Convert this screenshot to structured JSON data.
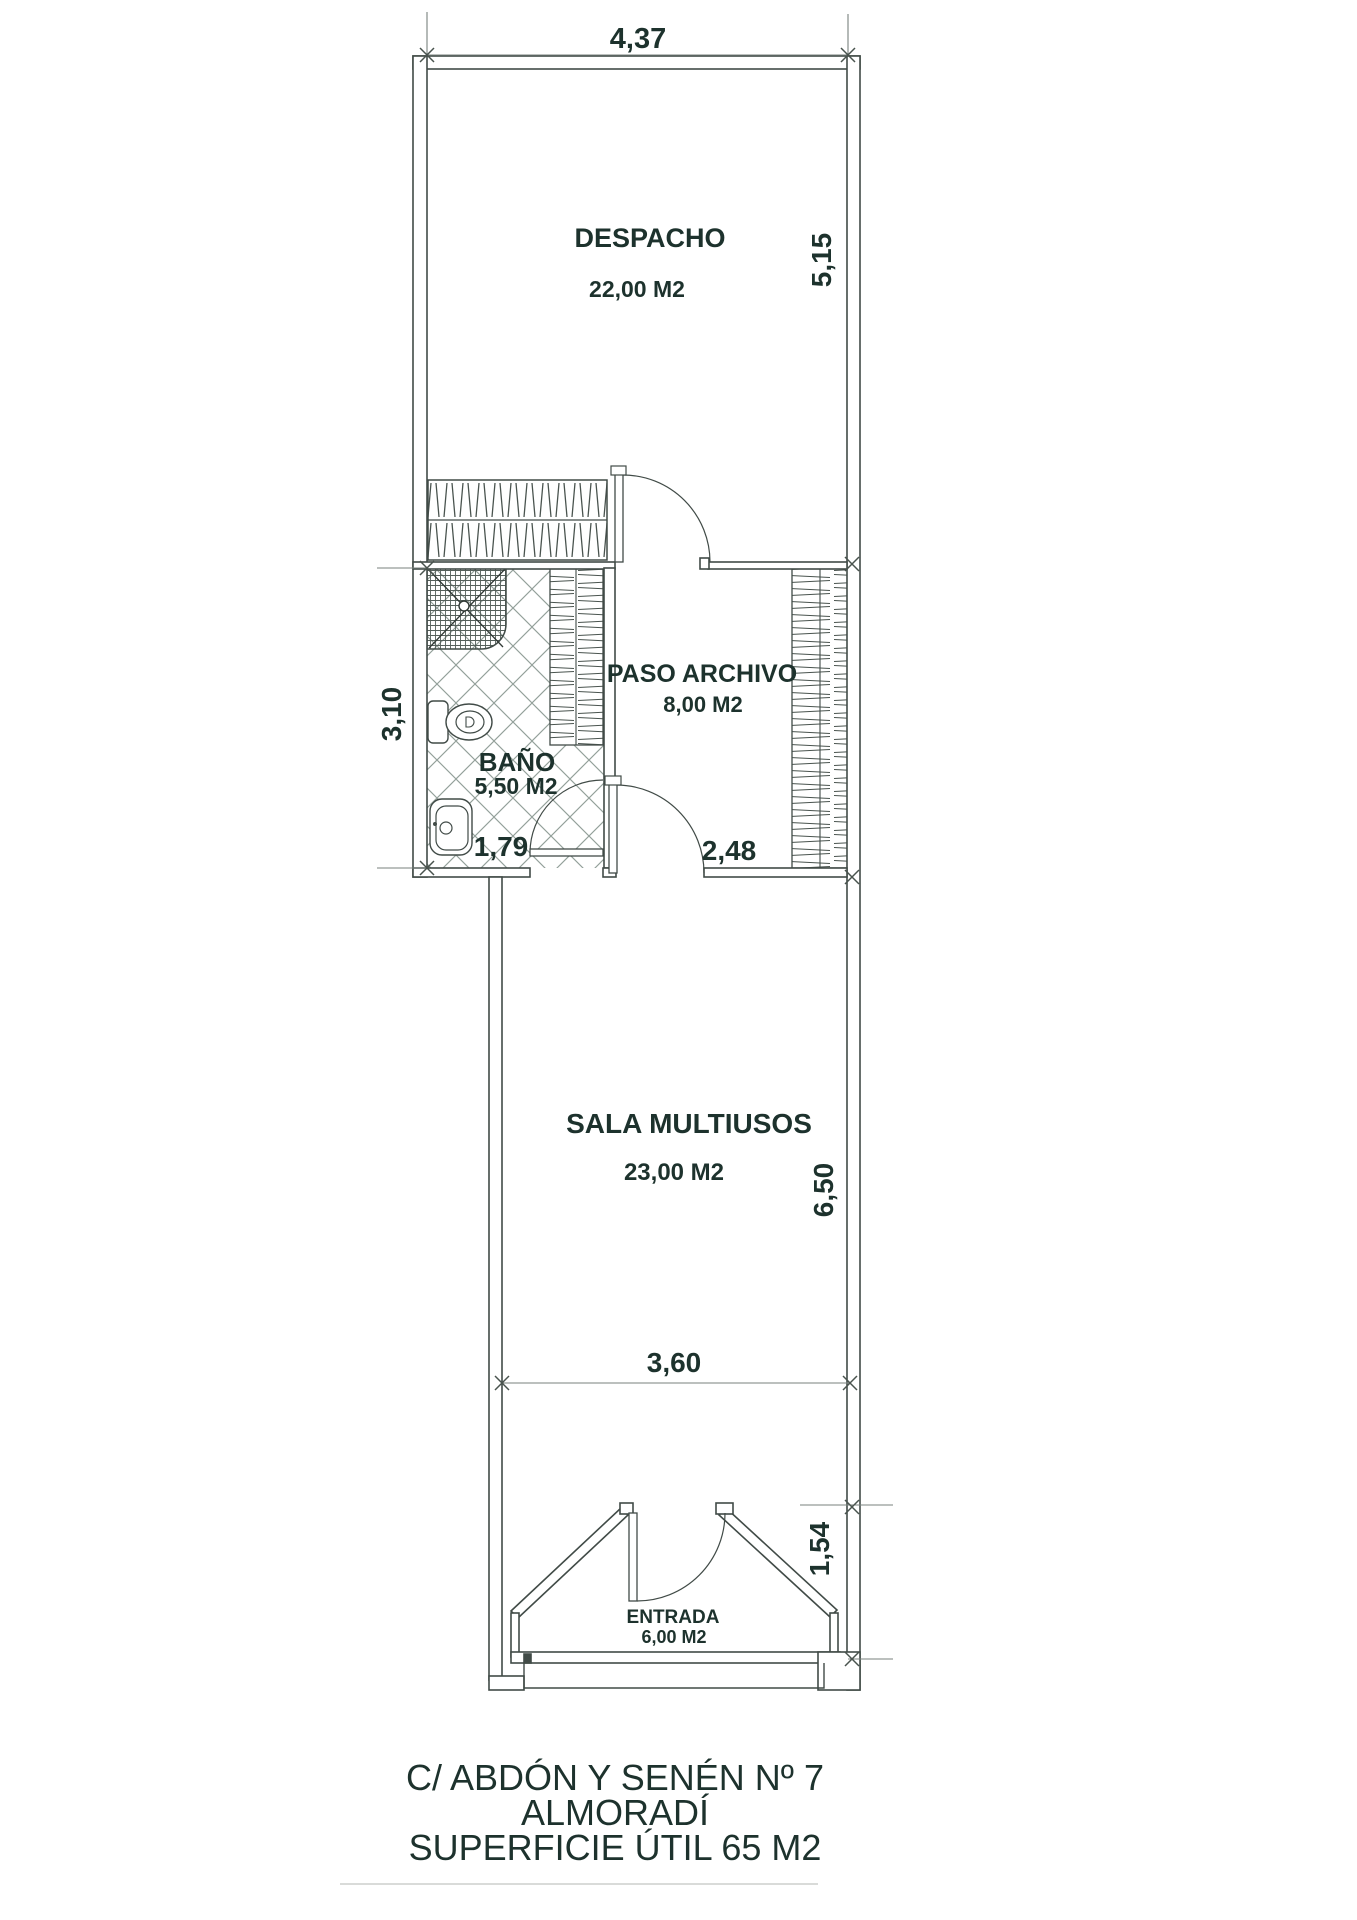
{
  "plan": {
    "rooms": [
      {
        "id": "despacho",
        "name": "DESPACHO",
        "area": "22,00 M2"
      },
      {
        "id": "bano",
        "name": "BAÑO",
        "area": "5,50 M2"
      },
      {
        "id": "paso_archivo",
        "name": "PASO ARCHIVO",
        "area": "8,00 M2"
      },
      {
        "id": "sala_multiusos",
        "name": "SALA MULTIUSOS",
        "area": "23,00 M2"
      },
      {
        "id": "entrada",
        "name": "ENTRADA",
        "area": "6,00 M2"
      }
    ],
    "dims": {
      "top_width": "4,37",
      "despacho_height": "5,15",
      "bano_height": "3,10",
      "bano_width": "1,79",
      "paso_width": "2,48",
      "sala_width": "3,60",
      "sala_height": "6,50",
      "entrada_depth": "1,54"
    },
    "title": {
      "line1": "C/ ABDÓN Y SENÉN Nº 7",
      "line2": "ALMORADÍ",
      "line3": "SUPERFICIE ÚTIL 65 M2"
    },
    "colors": {
      "wall_line": "#414b47",
      "dim_line": "#78827e",
      "text": "#1d322d",
      "tile_line": "#93a09a"
    }
  }
}
